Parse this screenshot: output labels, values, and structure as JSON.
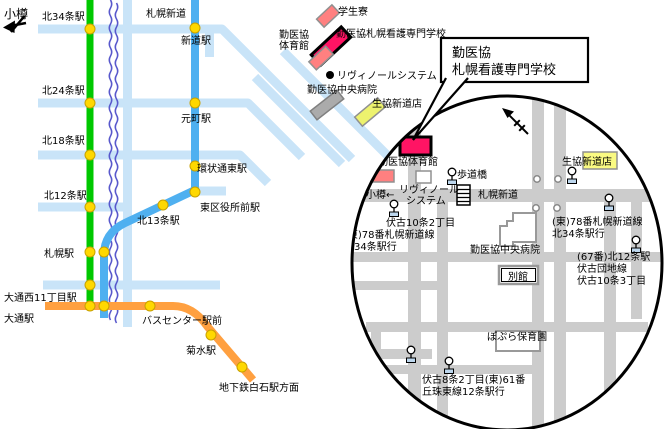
{
  "region_map": {
    "compass_label": "小樽",
    "road_label": "札幌新道",
    "stations": [
      "北34条駅",
      "新道駅",
      "北24条駅",
      "元町駅",
      "北18条駅",
      "環状通東駅",
      "北12条駅",
      "東区役所前駅",
      "北13条駅",
      "札幌駅",
      "大通西11丁目駅",
      "大通駅",
      "バスセンター駅前",
      "菊水駅",
      "地下鉄白石駅方面"
    ],
    "landmarks": [
      "学生寮",
      "勤医協札幌看護専門学校",
      "勤医協",
      "体育館",
      "リヴィノールシステム",
      "勤医協中央病院",
      "生協新道店"
    ],
    "colors": {
      "road_blue": "#C9E4F8",
      "river_blue": "#5858CC",
      "namboku_green": "#00C800",
      "toho_blue": "#4FB0F0",
      "tozai_orange": "#FFA040",
      "station_yellow": "#FFD800",
      "school_pink": "#FF1464",
      "building_salmon": "#FF8080",
      "building_gray": "#ABABAB",
      "coop_yellow_green": "#EDF26E"
    }
  },
  "callout": {
    "line1": "勤医協",
    "line2": "札幌看護専門学校"
  },
  "inset": {
    "labels": {
      "gym": "勤医協体育館",
      "pedestrian_bridge": "歩道橋",
      "to_otaru": "至小樽←",
      "rivinol_line1": "リヴィノール",
      "rivinol_line2": "システム",
      "sapporo_shindo": "札幌新道",
      "fushiko_10_2": "伏古10条2丁目",
      "bus_78_west_line1": "(東)78番札幌新道線",
      "bus_78_west_line2": "北34条駅行",
      "coop_shindo": "生協新道店",
      "bus_78_east_line1": "(東)78番札幌新道線",
      "bus_78_east_line2": "北34条駅行",
      "bus_67_line1": "(67番)北12条駅",
      "bus_67_line2": "伏古団地線",
      "bus_67_line3": "伏古10条3丁目",
      "hospital": "勤医協中央病院",
      "annex": "別館",
      "nursery": "ぽぷら保育園",
      "bus_61_line1": "伏古8条2丁目(東)61番",
      "bus_61_line2": "丘珠東線12条駅行"
    },
    "colors": {
      "road_gray": "#CCCCCC",
      "gym_pink": "#FF1464",
      "coop_yellow": "#FAFA82"
    }
  }
}
